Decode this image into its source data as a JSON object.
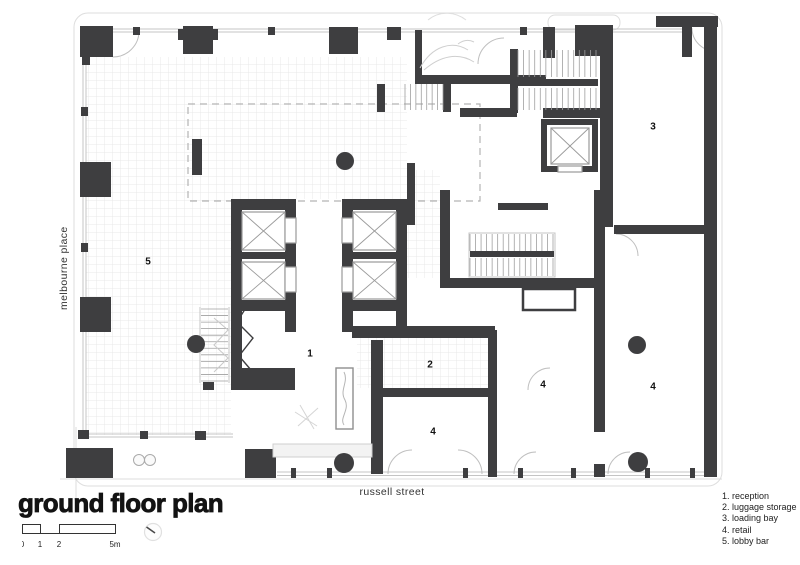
{
  "title": "ground floor plan",
  "streets": {
    "left": "melbourne place",
    "bottom": "russell street"
  },
  "scale_bar": {
    "labels": [
      "0",
      "1",
      "2",
      "5m"
    ]
  },
  "legend": {
    "items": [
      {
        "num": "1.",
        "label": "reception"
      },
      {
        "num": "2.",
        "label": "luggage storage"
      },
      {
        "num": "3.",
        "label": "loading bay"
      },
      {
        "num": "4.",
        "label": "retail"
      },
      {
        "num": "5.",
        "label": "lobby bar"
      }
    ]
  },
  "rooms": [
    {
      "label": "1",
      "x": 310,
      "y": 354
    },
    {
      "label": "2",
      "x": 430,
      "y": 365
    },
    {
      "label": "3",
      "x": 653,
      "y": 127
    },
    {
      "label": "4",
      "x": 433,
      "y": 432
    },
    {
      "label": "4",
      "x": 543,
      "y": 385
    },
    {
      "label": "4",
      "x": 653,
      "y": 387
    },
    {
      "label": "5",
      "x": 148,
      "y": 262
    }
  ],
  "colors": {
    "wall": "#3e3e40",
    "line": "#c4c4c4",
    "grid": "#e8e8e8",
    "dashed": "#b3b3b3",
    "text": "#1c1c1c"
  }
}
